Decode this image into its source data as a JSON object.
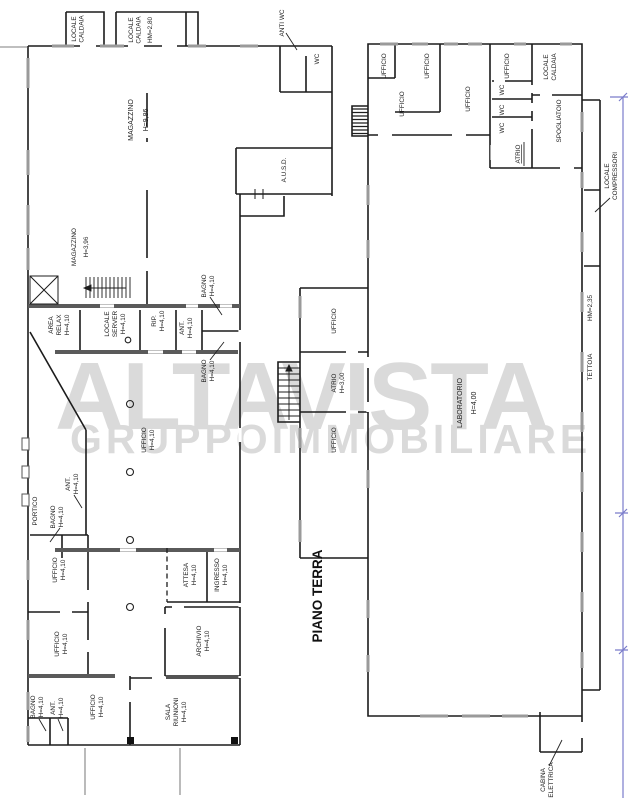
{
  "title": {
    "text": "PIANO TERRA"
  },
  "watermark": {
    "line1": "ALTAVISTA",
    "line2": "GRUPPOIMMOBILIARE"
  },
  "colors": {
    "line": "#1c1c1c",
    "thick_wall": "#5a5a5a",
    "window_gray": "#9a9a9a",
    "dimension_blue": "#7a7ccb",
    "watermark_gray": "#dadada"
  },
  "labels": [
    {
      "id": "locale-caldaia-1",
      "lines": [
        "LOCALE",
        "CALDAIA"
      ]
    },
    {
      "id": "locale-caldaia-2",
      "lines": [
        "LOCALE",
        "CALDAIA",
        "HM=2,80"
      ]
    },
    {
      "id": "anti-wc",
      "lines": [
        "ANTI WC"
      ]
    },
    {
      "id": "wc-left",
      "lines": [
        "WC"
      ]
    },
    {
      "id": "magazzino-grande",
      "lines": [
        "MAGAZZINO",
        "H=9,86"
      ]
    },
    {
      "id": "ausd",
      "lines": [
        "A.U.S.D."
      ]
    },
    {
      "id": "magazzino-piccolo",
      "lines": [
        "MAGAZZINO",
        "H=3,96"
      ]
    },
    {
      "id": "area-relax",
      "lines": [
        "AREA",
        "RELAX",
        "H=4,10"
      ]
    },
    {
      "id": "locale-server",
      "lines": [
        "LOCALE",
        "SERVER",
        "H=4,10"
      ]
    },
    {
      "id": "rip",
      "lines": [
        "RIP.",
        "H=4,10"
      ]
    },
    {
      "id": "ant-1",
      "lines": [
        "ANT.",
        "H=4,10"
      ]
    },
    {
      "id": "bagno-1",
      "lines": [
        "BAGNO",
        "H=4,10"
      ]
    },
    {
      "id": "bagno-2",
      "lines": [
        "BAGNO",
        "H=4,10"
      ]
    },
    {
      "id": "portico",
      "lines": [
        "PORTICO"
      ]
    },
    {
      "id": "ant-2",
      "lines": [
        "ANT.",
        "H=4,10"
      ]
    },
    {
      "id": "bagno-3",
      "lines": [
        "BAGNO",
        "H=4,10"
      ]
    },
    {
      "id": "ufficio-open",
      "lines": [
        "UFFICIO",
        "H=4,10"
      ]
    },
    {
      "id": "ufficio-a",
      "lines": [
        "UFFICIO",
        "H=4,10"
      ]
    },
    {
      "id": "attesa",
      "lines": [
        "ATTESA",
        "H=4,10"
      ]
    },
    {
      "id": "ingresso",
      "lines": [
        "INGRESSO",
        "H=4,10"
      ]
    },
    {
      "id": "ufficio-b",
      "lines": [
        "UFFICIO",
        "H=4,10"
      ]
    },
    {
      "id": "archivio",
      "lines": [
        "ARCHIVIO",
        "H=4,10"
      ]
    },
    {
      "id": "bagno-4",
      "lines": [
        "BAGNO",
        "H=4,10"
      ]
    },
    {
      "id": "ant-3",
      "lines": [
        "ANT.",
        "H=4,10"
      ]
    },
    {
      "id": "ufficio-c",
      "lines": [
        "UFFICIO",
        "H=4,10"
      ]
    },
    {
      "id": "sala-riunioni",
      "lines": [
        "SALA",
        "RIUNIONI",
        "H=4,10"
      ]
    },
    {
      "id": "ufficio-r1",
      "lines": [
        "UFFICIO"
      ]
    },
    {
      "id": "ufficio-r2",
      "lines": [
        "UFFICIO"
      ]
    },
    {
      "id": "ufficio-r3",
      "lines": [
        "UFFICIO"
      ]
    },
    {
      "id": "locale-caldaia-3",
      "lines": [
        "LOCALE",
        "CALDAIA"
      ]
    },
    {
      "id": "ufficio-r4",
      "lines": [
        "UFFICIO"
      ]
    },
    {
      "id": "ufficio-r5",
      "lines": [
        "UFFICIO"
      ]
    },
    {
      "id": "wc-1",
      "lines": [
        "WC"
      ]
    },
    {
      "id": "wc-2",
      "lines": [
        "WC"
      ]
    },
    {
      "id": "wc-3",
      "lines": [
        "WC"
      ]
    },
    {
      "id": "spogliatoio",
      "lines": [
        "SPOGLIATOIO"
      ]
    },
    {
      "id": "atrio-servizi",
      "lines": [
        "ATRIO"
      ]
    },
    {
      "id": "ufficio-annex-1",
      "lines": [
        "UFFICIO"
      ]
    },
    {
      "id": "atrio-annex",
      "lines": [
        "ATRIO",
        "H=3,00"
      ]
    },
    {
      "id": "ufficio-annex-2",
      "lines": [
        "UFFICIO"
      ]
    },
    {
      "id": "laboratorio",
      "lines": [
        "LABORATORIO",
        "H=4,00"
      ]
    },
    {
      "id": "tettoia-altezza",
      "lines": [
        "HM=2,35"
      ]
    },
    {
      "id": "tettoia",
      "lines": [
        "TETTOIA"
      ]
    },
    {
      "id": "locale-compressori",
      "lines": [
        "LOCALE",
        "COMPRESSORI"
      ]
    },
    {
      "id": "cabina-elettrica",
      "lines": [
        "CABINA",
        "ELETTRICA"
      ]
    }
  ]
}
